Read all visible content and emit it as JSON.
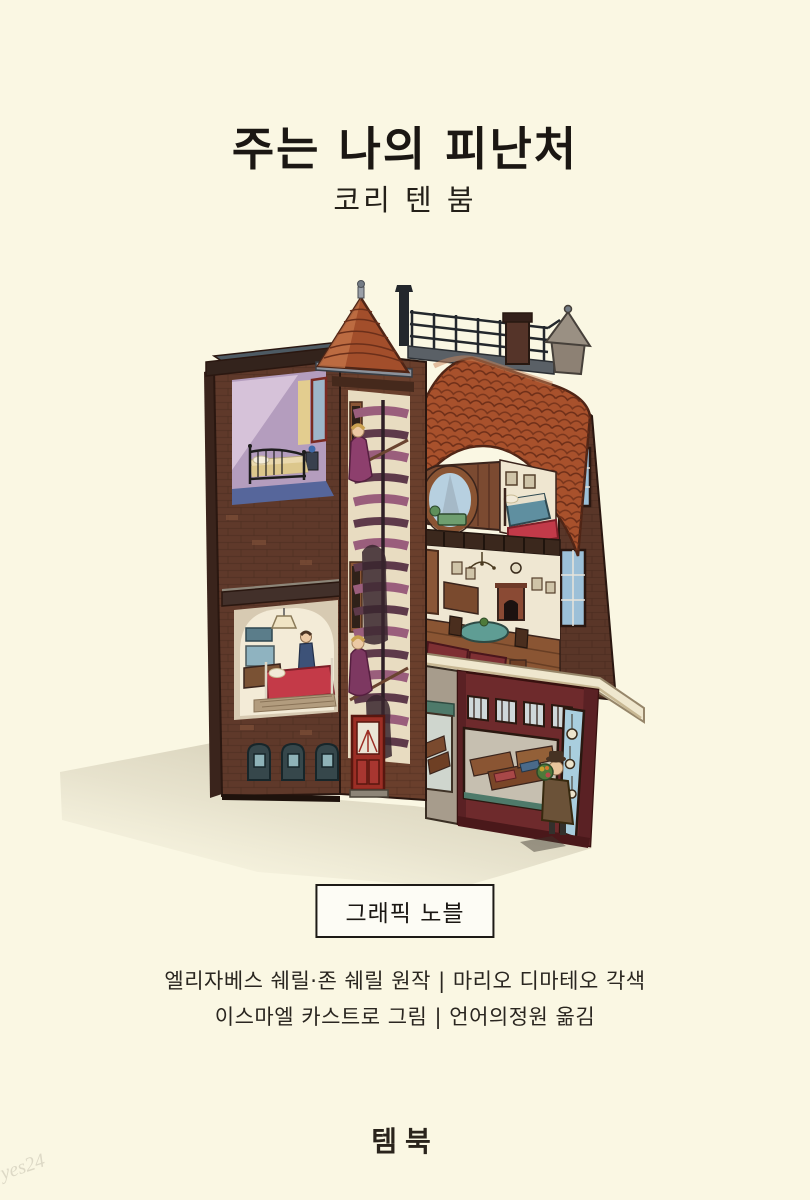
{
  "palette": {
    "background": "#FAF7E3",
    "ink": "#1B1713",
    "badge_background": "#FDFCF5",
    "badge_border": "#1D1A16",
    "brick": "#5F392A",
    "brick_tower": "#6A3F2C",
    "roof_tile": "#A8512C",
    "roof_outline": "#4F2516",
    "bedroom_purple": "#B49DBE",
    "bedroom_floor_blue": "#56669B",
    "stair_plum": "#9A5E7C",
    "robe_purple": "#8D3F6D",
    "bed_red": "#C43A48",
    "bed_green": "#6F9E6F",
    "bed_teal": "#5F8FA0",
    "table_teal": "#5F9D94",
    "shop_maroon": "#6E2A2C",
    "awning_green": "#4E7A6A",
    "window_blue": "#9CC0D8",
    "shadow": "#B6AD92",
    "watermark_gray": "#D8D4C2"
  },
  "cover": {
    "title": "주는 나의 피난처",
    "author": "코리 텐 붐",
    "category_badge": "그래픽 노블",
    "credits": [
      "엘리자베스 쉐릴·존 쉐릴 원작 | 마리오 디마테오 각색",
      "이스마엘 카스트로 그림 | 언어의정원 옮김"
    ],
    "publisher": "템북",
    "watermark": "yes24"
  },
  "illustration": {
    "alt": "Cutaway cross-section of a Dutch brick canal house: purple attic bedroom with an iron bed, spiral-staircase tower with two women in purple robes climbing, terracotta tiled roof with rooftop terrace, stovepipe and chimney, round attic window with a green bed, bedroom with teal bed and red rug, parlor with fireplace and round teal table, basement room with red bed and kitchen, arched cellar windows, and a watchmaker's shop at street level with a man holding flowers at the corner door."
  }
}
